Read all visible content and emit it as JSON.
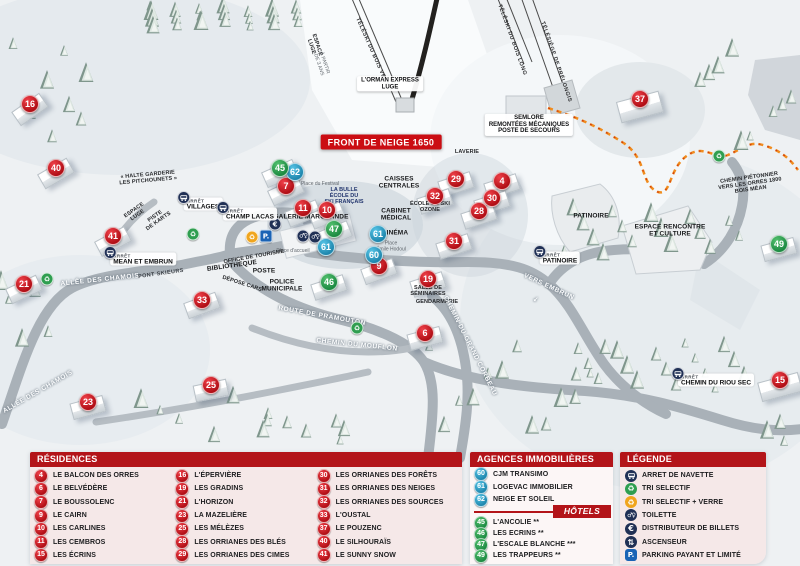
{
  "map": {
    "banner": "FRONT DE NEIGE 1650",
    "markers": [
      {
        "n": "16",
        "t": "res",
        "x": 29,
        "y": 103,
        "br": -35
      },
      {
        "n": "40",
        "t": "res",
        "x": 55,
        "y": 167,
        "br": -30
      },
      {
        "n": "41",
        "t": "res",
        "x": 112,
        "y": 235,
        "br": -28
      },
      {
        "n": "21",
        "t": "res",
        "x": 23,
        "y": 283,
        "br": -25
      },
      {
        "n": "23",
        "t": "res",
        "x": 87,
        "y": 401,
        "br": -15
      },
      {
        "n": "33",
        "t": "res",
        "x": 201,
        "y": 299,
        "br": -20
      },
      {
        "n": "25",
        "t": "res",
        "x": 210,
        "y": 384,
        "br": -12
      },
      {
        "n": "7",
        "t": "res",
        "x": 285,
        "y": 185,
        "br": -25
      },
      {
        "n": "11",
        "t": "res",
        "x": 302,
        "y": 207,
        "br": -22
      },
      {
        "n": "10",
        "t": "res",
        "x": 326,
        "y": 209,
        "br": -22
      },
      {
        "n": "9",
        "t": "res",
        "x": 378,
        "y": 265,
        "br": -20
      },
      {
        "n": "29",
        "t": "res",
        "x": 455,
        "y": 178,
        "br": -18
      },
      {
        "n": "32",
        "t": "res",
        "x": 434,
        "y": 195,
        "br": -18
      },
      {
        "n": "4",
        "t": "res",
        "x": 501,
        "y": 180,
        "br": -18
      },
      {
        "n": "30",
        "t": "res",
        "x": 491,
        "y": 197,
        "br": -18
      },
      {
        "n": "28",
        "t": "res",
        "x": 478,
        "y": 210,
        "br": -18
      },
      {
        "n": "31",
        "t": "res",
        "x": 453,
        "y": 240,
        "br": -18
      },
      {
        "n": "19",
        "t": "res",
        "x": 427,
        "y": 278,
        "br": -18
      },
      {
        "n": "6",
        "t": "res",
        "x": 424,
        "y": 332,
        "br": -15
      },
      {
        "n": "37",
        "t": "res",
        "x": 639,
        "y": 98,
        "br": -15,
        "bw": 42,
        "bh": 20
      },
      {
        "n": "15",
        "t": "res",
        "x": 779,
        "y": 379,
        "br": -15,
        "bw": 40,
        "bh": 18
      },
      {
        "n": "62",
        "t": "ag",
        "x": 294,
        "y": 171
      },
      {
        "n": "61",
        "t": "ag",
        "x": 325,
        "y": 246
      },
      {
        "n": "61",
        "t": "ag",
        "x": 377,
        "y": 233
      },
      {
        "n": "60",
        "t": "ag",
        "x": 373,
        "y": 254
      },
      {
        "n": "45",
        "t": "hot",
        "x": 279,
        "y": 167,
        "br": -24
      },
      {
        "n": "47",
        "t": "hot",
        "x": 333,
        "y": 228,
        "br": -22
      },
      {
        "n": "46",
        "t": "hot",
        "x": 328,
        "y": 281,
        "br": -18
      },
      {
        "n": "49",
        "t": "hot",
        "x": 778,
        "y": 243,
        "br": -15
      }
    ],
    "labels": [
      {
        "lines": [
          "LAVERIE"
        ],
        "x": 467,
        "y": 152,
        "c": "poism"
      },
      {
        "lines": [
          "CAISSES",
          "CENTRALES"
        ],
        "x": 399,
        "y": 183,
        "c": "poi"
      },
      {
        "lines": [
          "CABINET",
          "MÉDICAL"
        ],
        "x": 396,
        "y": 215,
        "c": "poi"
      },
      {
        "lines": [
          "CINÉMA"
        ],
        "x": 395,
        "y": 233,
        "c": "poi"
      },
      {
        "lines": [
          "Place",
          "Émile Hodoul"
        ],
        "x": 391,
        "y": 247,
        "c": "place"
      },
      {
        "lines": [
          "Place du Festival"
        ],
        "x": 320,
        "y": 185,
        "c": "place"
      },
      {
        "lines": [
          "Place d'accueil"
        ],
        "x": 293,
        "y": 252,
        "c": "place"
      },
      {
        "lines": [
          "LA BULLE",
          "ÉCOLE DU",
          "SKI FRANÇAIS"
        ],
        "x": 344,
        "y": 196,
        "c": "blue"
      },
      {
        "lines": [
          "GALERIE MARCHANDE"
        ],
        "x": 311,
        "y": 217,
        "c": "poi"
      },
      {
        "lines": [
          "ÉCOLE DE SKI",
          "OZONE"
        ],
        "x": 430,
        "y": 207,
        "c": "poism"
      },
      {
        "lines": [
          "BIBLIOTHÈQUE"
        ],
        "x": 232,
        "y": 266,
        "c": "poi",
        "r": -8
      },
      {
        "lines": [
          "OFFICE DE TOURISME"
        ],
        "x": 254,
        "y": 257,
        "c": "poism",
        "r": -10
      },
      {
        "lines": [
          "POSTE"
        ],
        "x": 264,
        "y": 271,
        "c": "poi"
      },
      {
        "lines": [
          "POLICE",
          "MUNICIPALE"
        ],
        "x": 282,
        "y": 286,
        "c": "poi"
      },
      {
        "lines": [
          "DÉPOSE CARS"
        ],
        "x": 242,
        "y": 284,
        "c": "poism",
        "r": 18
      },
      {
        "lines": [
          "GENDARMERIE"
        ],
        "x": 437,
        "y": 302,
        "c": "poism"
      },
      {
        "lines": [
          "SALLE DE",
          "SÉMINAIRES"
        ],
        "x": 428,
        "y": 291,
        "c": "poism"
      },
      {
        "lines": [
          "PATINOIRE"
        ],
        "x": 591,
        "y": 216,
        "c": "poi"
      },
      {
        "lines": [
          "ESPACE RENCONTRE",
          "ET CULTURE"
        ],
        "x": 670,
        "y": 231,
        "c": "poi"
      },
      {
        "lines": [
          "« HALTE GARDERIE",
          "LES PITCHOUNETS »"
        ],
        "x": 148,
        "y": 178,
        "c": "poism",
        "r": -5
      },
      {
        "lines": [
          "ESPACE",
          "LUGE"
        ],
        "x": 136,
        "y": 213,
        "c": "poism",
        "r": -35
      },
      {
        "lines": [
          "PISTE",
          "DE KARTS"
        ],
        "x": 157,
        "y": 219,
        "c": "poism",
        "r": -35
      },
      {
        "lines": [
          "ESPACE",
          "LUGE"
        ],
        "x": 314,
        "y": 46,
        "c": "poism",
        "r": 72
      },
      {
        "lines": [
          "À PARTIR",
          "DE 3 ANS"
        ],
        "x": 321,
        "y": 64,
        "c": "place",
        "r": 72
      },
      {
        "lines": [
          "TÉLÉSKI DU BOIS VERT"
        ],
        "x": 372,
        "y": 52,
        "c": "lift",
        "r": 66
      },
      {
        "lines": [
          "TÉLÉSKI DU BOIS LONG"
        ],
        "x": 512,
        "y": 40,
        "c": "lift",
        "r": 70
      },
      {
        "lines": [
          "TÉLÉSIÈGE DE PRÉLONGIS"
        ],
        "x": 556,
        "y": 62,
        "c": "lift",
        "r": 71
      },
      {
        "lines": [
          "L'ORMAN EXPRESS",
          "LUGE"
        ],
        "x": 390,
        "y": 84,
        "c": "box"
      },
      {
        "lines": [
          "SEMLORE",
          "REMONTÉES MÉCANIQUES",
          "POSTE DE SECOURS"
        ],
        "x": 529,
        "y": 125,
        "c": "box"
      },
      {
        "lines": [
          "FRONT DE NEIGE 1650"
        ],
        "x": 381,
        "y": 142,
        "c": "banner"
      },
      {
        "lines": [
          "ALLÉE DES CHAMOIS"
        ],
        "x": 100,
        "y": 280,
        "c": "road",
        "r": -6
      },
      {
        "lines": [
          "ALLÉE DES CHAMOIS"
        ],
        "x": 38,
        "y": 392,
        "c": "road",
        "r": -30
      },
      {
        "lines": [
          "PONT SKIEURS"
        ],
        "x": 161,
        "y": 274,
        "c": "roaddk",
        "r": -8
      },
      {
        "lines": [
          "ROUTE DE PRAMOUTON"
        ],
        "x": 322,
        "y": 316,
        "c": "road",
        "r": 10
      },
      {
        "lines": [
          "CHEMIN DU MOUFLON"
        ],
        "x": 357,
        "y": 345,
        "c": "road",
        "r": 6
      },
      {
        "lines": [
          "CHEMIN DU GRAND CORBEAU"
        ],
        "x": 470,
        "y": 346,
        "c": "road",
        "r": 63
      },
      {
        "lines": [
          "VERS EMBRUN"
        ],
        "x": 549,
        "y": 287,
        "c": "road",
        "r": 25
      },
      {
        "lines": [
          "↙"
        ],
        "x": 536,
        "y": 300,
        "c": "road"
      },
      {
        "lines": [
          "CHEMIN PIÉTONNIER",
          "VERS LES ORRES 1800",
          "BOIS MÉAN"
        ],
        "x": 750,
        "y": 184,
        "c": "poism",
        "r": -8
      }
    ],
    "bus_stops": [
      {
        "arret": "ARRÊT",
        "name": "VILLAGES",
        "x": 203,
        "y": 204,
        "side": "right"
      },
      {
        "arret": "ARRÊT",
        "name": "CHAMP LACAS",
        "x": 250,
        "y": 214,
        "side": "left"
      },
      {
        "arret": "ARRÊT",
        "name": "MEAN ET EMBRUN",
        "x": 143,
        "y": 259,
        "side": "right"
      },
      {
        "arret": "ARRÊT",
        "name": "PATINOIRE",
        "x": 560,
        "y": 258,
        "side": "left"
      },
      {
        "arret": "ARRÊT",
        "name": "CHEMIN DU RIOU SEC",
        "x": 716,
        "y": 380,
        "side": "left"
      }
    ],
    "icons": [
      {
        "t": "euro",
        "x": 275,
        "y": 224
      },
      {
        "t": "toilet",
        "x": 303,
        "y": 236
      },
      {
        "t": "toilet",
        "x": 315,
        "y": 237
      },
      {
        "t": "reco",
        "x": 252,
        "y": 237
      },
      {
        "t": "park",
        "x": 266,
        "y": 236
      },
      {
        "t": "recg",
        "x": 193,
        "y": 234
      },
      {
        "t": "recg",
        "x": 47,
        "y": 279
      },
      {
        "t": "recg",
        "x": 357,
        "y": 328
      },
      {
        "t": "recg",
        "x": 719,
        "y": 156
      }
    ]
  },
  "legend": {
    "residences": {
      "title": "RÉSIDENCES",
      "items": [
        {
          "n": "4",
          "name": "LE BALCON DES ORRES"
        },
        {
          "n": "6",
          "name": "LE BELVÉDÈRE"
        },
        {
          "n": "7",
          "name": "LE BOUSSOLENC"
        },
        {
          "n": "9",
          "name": "LE CAIRN"
        },
        {
          "n": "10",
          "name": "LES CARLINES"
        },
        {
          "n": "11",
          "name": "LES CEMBROS"
        },
        {
          "n": "15",
          "name": "LES ÉCRINS"
        },
        {
          "n": "16",
          "name": "L'ÉPERVIÈRE"
        },
        {
          "n": "19",
          "name": "LES GRADINS"
        },
        {
          "n": "21",
          "name": "L'HORIZON"
        },
        {
          "n": "23",
          "name": "LA MAZELIÈRE"
        },
        {
          "n": "25",
          "name": "LES MÉLÈZES"
        },
        {
          "n": "28",
          "name": "LES ORRIANES DES BLÉS"
        },
        {
          "n": "29",
          "name": "LES ORRIANES DES CIMES"
        },
        {
          "n": "30",
          "name": "LES ORRIANES DES FORÊTS"
        },
        {
          "n": "31",
          "name": "LES ORRIANES DES NEIGES"
        },
        {
          "n": "32",
          "name": "LES ORRIANES DES SOURCES"
        },
        {
          "n": "33",
          "name": "L'OUSTAL"
        },
        {
          "n": "37",
          "name": "LE POUZENC"
        },
        {
          "n": "40",
          "name": "LE SILHOURAÏS"
        },
        {
          "n": "41",
          "name": "LE SUNNY SNOW"
        }
      ]
    },
    "agences": {
      "title": "AGENCES IMMOBILIÈRES",
      "items": [
        {
          "n": "60",
          "name": "CJM TRANSIMO"
        },
        {
          "n": "61",
          "name": "LOGEVAC IMMOBILIER"
        },
        {
          "n": "62",
          "name": "NEIGE ET SOLEIL"
        }
      ]
    },
    "hotels": {
      "title": "HÔTELS",
      "items": [
        {
          "n": "45",
          "name": "L'ANCOLIE **"
        },
        {
          "n": "46",
          "name": "LES ECRINS **"
        },
        {
          "n": "47",
          "name": "L'ESCALE BLANCHE ***"
        },
        {
          "n": "49",
          "name": "LES TRAPPEURS **"
        }
      ]
    },
    "legende": {
      "title": "LÉGENDE",
      "items": [
        {
          "icon": "bus",
          "name": "ARRET DE NAVETTE"
        },
        {
          "icon": "recg",
          "name": "TRI SELECTIF"
        },
        {
          "icon": "reco",
          "name": "TRI SELECTIF + VERRE"
        },
        {
          "icon": "toilet",
          "name": "TOILETTE"
        },
        {
          "icon": "euro",
          "name": "DISTRIBUTEUR DE BILLETS"
        },
        {
          "icon": "asc",
          "name": "ASCENSEUR"
        },
        {
          "icon": "park",
          "name": "PARKING PAYANT ET LIMITÉ"
        }
      ]
    }
  },
  "colors": {
    "header_red": "#b31419",
    "marker_red": "#c4151c",
    "marker_blue": "#2d9fc6",
    "marker_green": "#2f9e50",
    "path_orange": "#f08c1e"
  }
}
